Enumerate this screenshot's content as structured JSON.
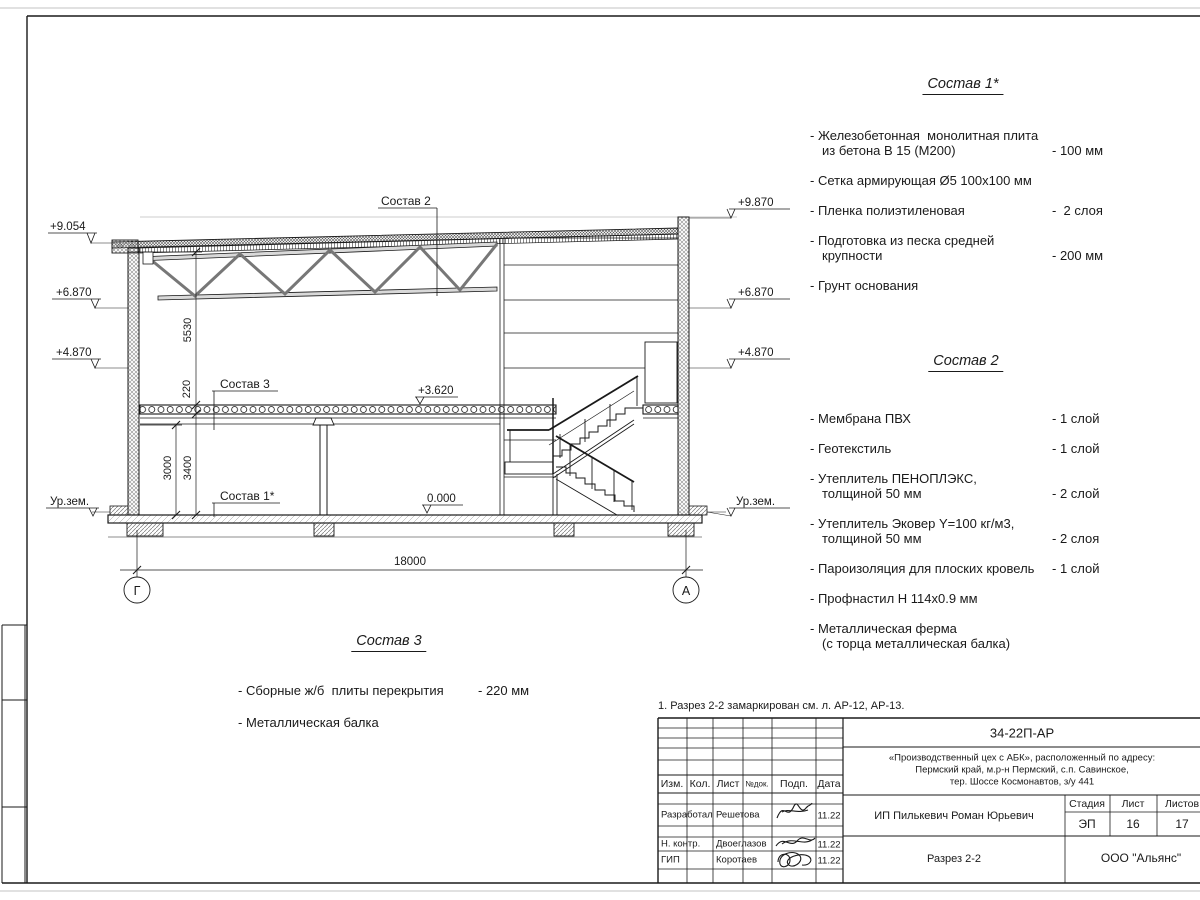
{
  "note": "1. Разрез 2-2 замаркирован см. л. АР-12, АР-13.",
  "drawing": {
    "dims": {
      "d5530": "5530",
      "d220": "220",
      "d3000": "3000",
      "d3400": "3400",
      "d18000": "18000"
    },
    "marks_left": [
      "+9.054",
      "+6.870",
      "+4.870",
      "Ур.зем."
    ],
    "marks_right": [
      "+9.870",
      "+6.870",
      "+4.870",
      "Ур.зем."
    ],
    "callouts": {
      "c2": "Состав 2",
      "c3": "Состав 3",
      "c1": "Состав 1*",
      "lvl_up": "+3.620",
      "lvl_zero": "0.000"
    },
    "axes": {
      "left": "Г",
      "right": "А"
    }
  },
  "sostav1": {
    "title": "Состав 1*",
    "items": [
      {
        "line1": "- Железобетонная  монолитная плита",
        "line2": "из бетона В 15 (М200)",
        "value": "- 100 мм"
      },
      {
        "line1": "- Сетка армирующая Ø5 100х100 мм"
      },
      {
        "line1": "- Пленка полиэтиленовая",
        "value": "-  2 слоя"
      },
      {
        "line1": "- Подготовка из песка средней",
        "line2": "крупности",
        "value": "- 200 мм"
      },
      {
        "line1": "- Грунт основания"
      }
    ]
  },
  "sostav2": {
    "title": "Состав 2",
    "items": [
      {
        "line1": "- Мембрана ПВХ",
        "value": "- 1 слой"
      },
      {
        "line1": "- Геотекстиль",
        "value": "- 1 слой"
      },
      {
        "line1": "- Утеплитель ПЕНОПЛЭКС,",
        "line2": "толщиной 50 мм",
        "value": "- 2 слой"
      },
      {
        "line1": "- Утеплитель Эковер Y=100 кг/м3,",
        "line2": "толщиной 50 мм",
        "value": "- 2 слоя"
      },
      {
        "line1": "- Пароизоляция для плоских кровель",
        "value": "- 1 слой"
      },
      {
        "line1": "- Профнастил Н 114х0.9 мм"
      },
      {
        "line1": "- Металлическая ферма",
        "line2": "(с торца металлическая балка)"
      }
    ]
  },
  "sostav3": {
    "title": "Состав 3",
    "items": [
      {
        "line1": "- Сборные ж/б  плиты перекрытия",
        "value": "- 220 мм"
      },
      {
        "line1": "- Металлическая балка"
      }
    ]
  },
  "stamp": {
    "doc_number": "34-22П-АР",
    "project_line1": "«Производственный цех с АБК», расположенный по адресу:",
    "project_line2": "Пермский край, м.р-н Пермский, с.п. Савинское,",
    "project_line3": "тер. Шоссе Космонавтов, з/у 441",
    "client": "ИП Пилькевич Роман Юрьевич",
    "stage_label": "Стадия",
    "sheet_label": "Лист",
    "sheets_label": "Листов",
    "stage": "ЭП",
    "sheet": "16",
    "sheets": "17",
    "drawing_title": "Разрез 2-2",
    "company": "ООО \"Альянс\"",
    "cols": {
      "izm": "Изм.",
      "kol": "Кол.",
      "list": "Лист",
      "ndok": "№док.",
      "podp": "Подп.",
      "data": "Дата"
    },
    "rows": [
      {
        "role": "Разработал",
        "name": "Решетова",
        "date": "11.22"
      },
      {
        "role": "Н. контр.",
        "name": "Двоеглазов",
        "date": "11.22"
      },
      {
        "role": "ГИП",
        "name": "Коротаев",
        "date": "11.22"
      }
    ]
  }
}
